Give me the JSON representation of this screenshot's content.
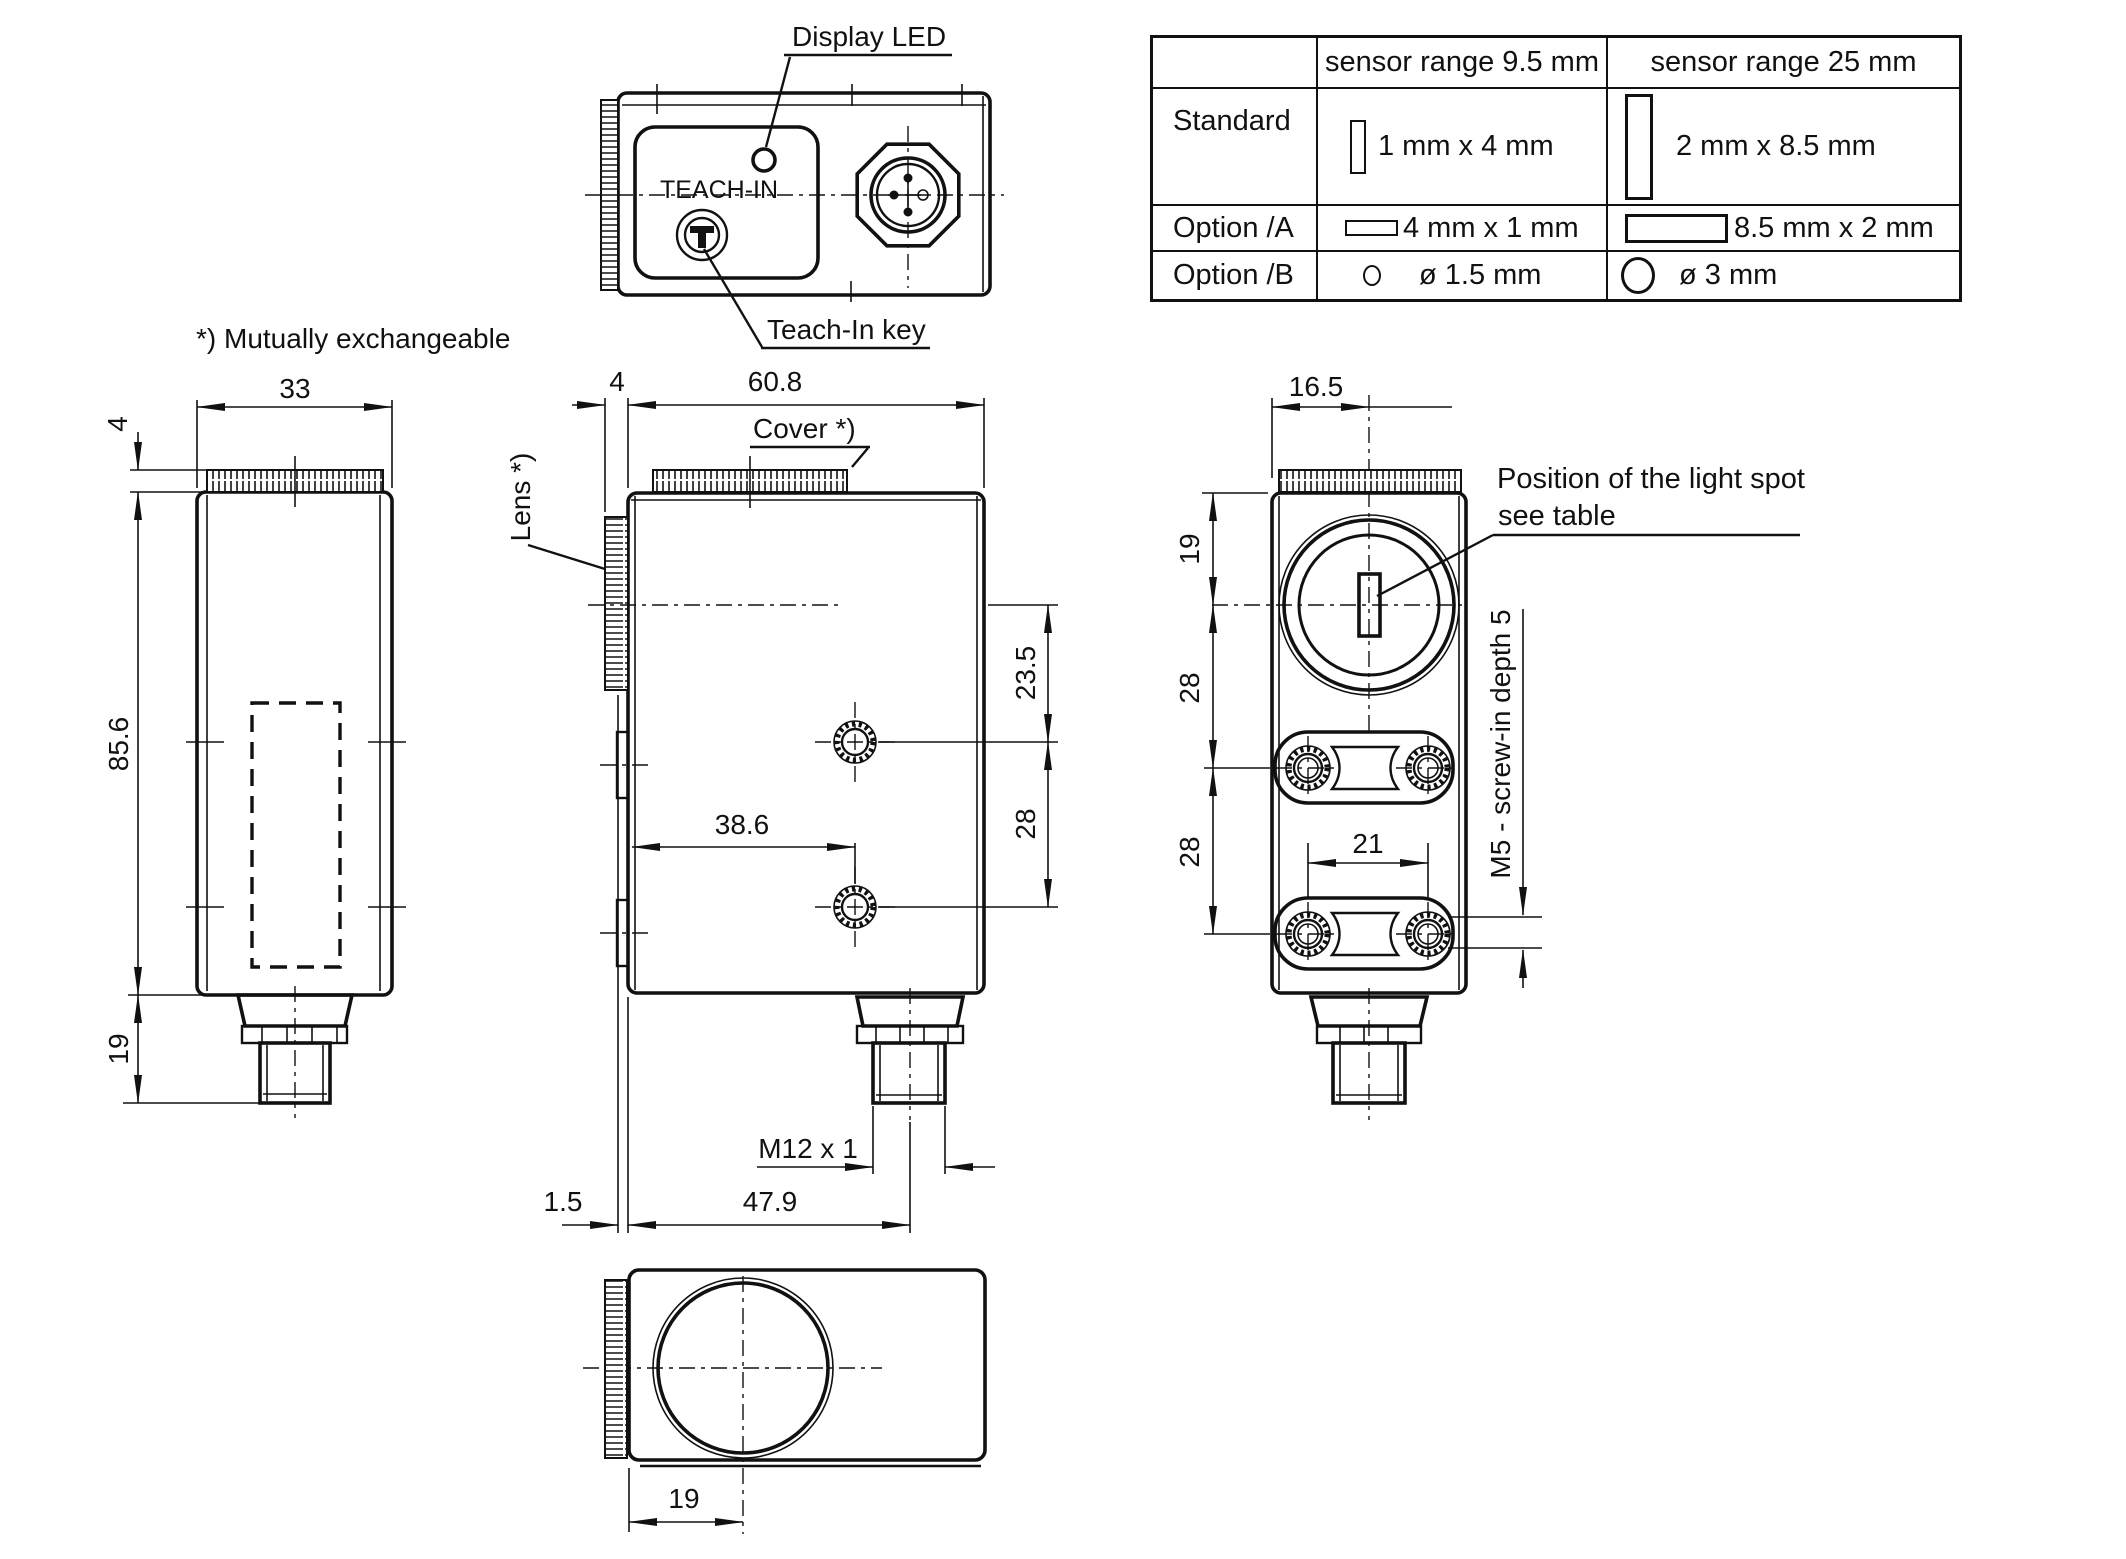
{
  "drawing": {
    "labels": {
      "display_led": "Display LED",
      "teach_in": "TEACH-IN",
      "teach_in_key": "Teach-In key",
      "mutually_exchangeable": "*) Mutually exchangeable",
      "cover": "Cover *)",
      "lens": "Lens *)",
      "light_spot_line1": "Position of the light spot",
      "light_spot_line2": "see table",
      "m5_note": "M5 - screw-in depth 5",
      "m12_thread": "M12 x 1"
    },
    "dims": {
      "side_width": "33",
      "side_ring": "4",
      "side_height": "85.6",
      "side_conn": "19",
      "front_lens_ring": "4",
      "front_width": "60.8",
      "front_hole_top": "23.5",
      "front_hole_gap": "28",
      "front_hole_x": "38.6",
      "front_conn_x": "47.9",
      "front_lens_face": "1.5",
      "face_center": "16.5",
      "face_lens_y": "19",
      "face_slot1": "28",
      "face_slot2": "28",
      "face_screw_gap": "21",
      "bottom_lens_x": "19"
    }
  },
  "table": {
    "headers": [
      "sensor range 9.5 mm",
      "sensor range 25 mm"
    ],
    "rows": [
      {
        "label": "Standard",
        "cell1": "1 mm x 4 mm",
        "cell2": "2 mm x 8.5 mm"
      },
      {
        "label": "Option /A",
        "cell1": "4 mm x 1 mm",
        "cell2": "8.5 mm x 2 mm"
      },
      {
        "label": "Option /B",
        "cell1": "ø 1.5 mm",
        "cell2": "ø 3 mm"
      }
    ]
  }
}
